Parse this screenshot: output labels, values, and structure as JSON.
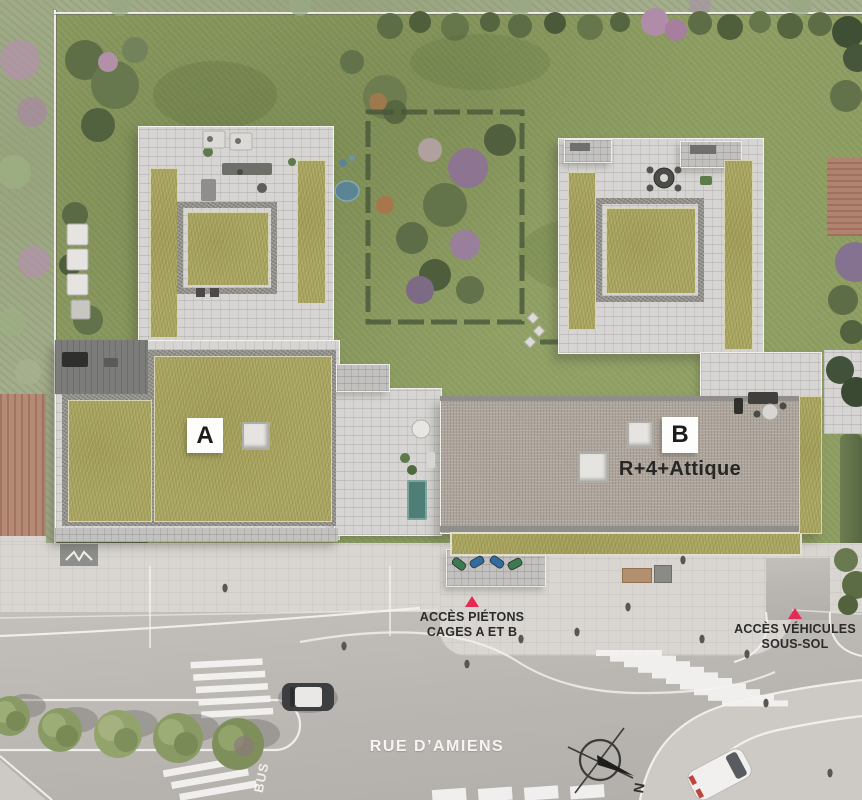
{
  "plan": {
    "title": "architectural-site-plan",
    "buildings": {
      "a": {
        "label": "A"
      },
      "b": {
        "label": "B",
        "height_note": "R+4+Attique"
      }
    },
    "annotations": {
      "pedestrian_access": {
        "line1": "ACCÈS PIÉTONS",
        "line2": "CAGES A ET B"
      },
      "vehicle_access": {
        "line1": "ACCÈS VÉHICULES",
        "line2": "SOUS-SOL"
      }
    },
    "streets": {
      "main": "RUE D’AMIENS"
    },
    "road_markings": {
      "bus_lane": "BUS"
    },
    "compass": {
      "north": "N"
    },
    "colors": {
      "lawn": "#8f9f64",
      "sedum_roof": "#a9a562",
      "paving": "#d6d5d3",
      "gravel_roof": "#b3aaa1",
      "road": "#bab6b2",
      "sidewalk": "#d9d6d2",
      "access_marker": "#e72a54",
      "pond": "#5c8494",
      "hedge": "#47573a",
      "terracotta_roof": "#b48a75"
    }
  }
}
